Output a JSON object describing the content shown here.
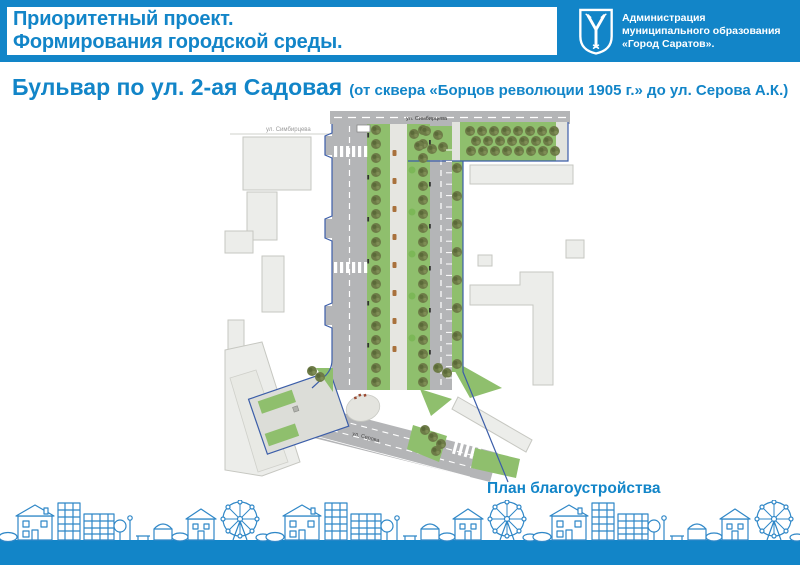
{
  "header": {
    "program": {
      "line1": "Приоритетный проект.",
      "line2": "Формирования городской среды."
    },
    "organization": {
      "line1": "Администрация",
      "line2": "муниципального образования",
      "line3": "«Город Саратов».",
      "logo_icon": "saratov-coat-of-arms"
    }
  },
  "title": {
    "main": "Бульвар по ул. 2-ая Садовая",
    "subtitle": "(от сквера «Борцов революции 1905 г.» до ул. Серова А.К.)"
  },
  "plan": {
    "caption": "План благоустройства",
    "street_labels": {
      "simbirtseva_left": "ул. Симбирцева",
      "simbirtseva_road": "ул. Симбирцева",
      "serova": "ул. Серова"
    }
  },
  "colors": {
    "accent": "#1285c8",
    "skyline_stroke": "#2f87c7",
    "lawn": "#8fbf6d",
    "road": "#b4b5b7",
    "tree": "#6d7b47",
    "project_boundary": "#3c5ea9",
    "building": "#ecedea"
  }
}
